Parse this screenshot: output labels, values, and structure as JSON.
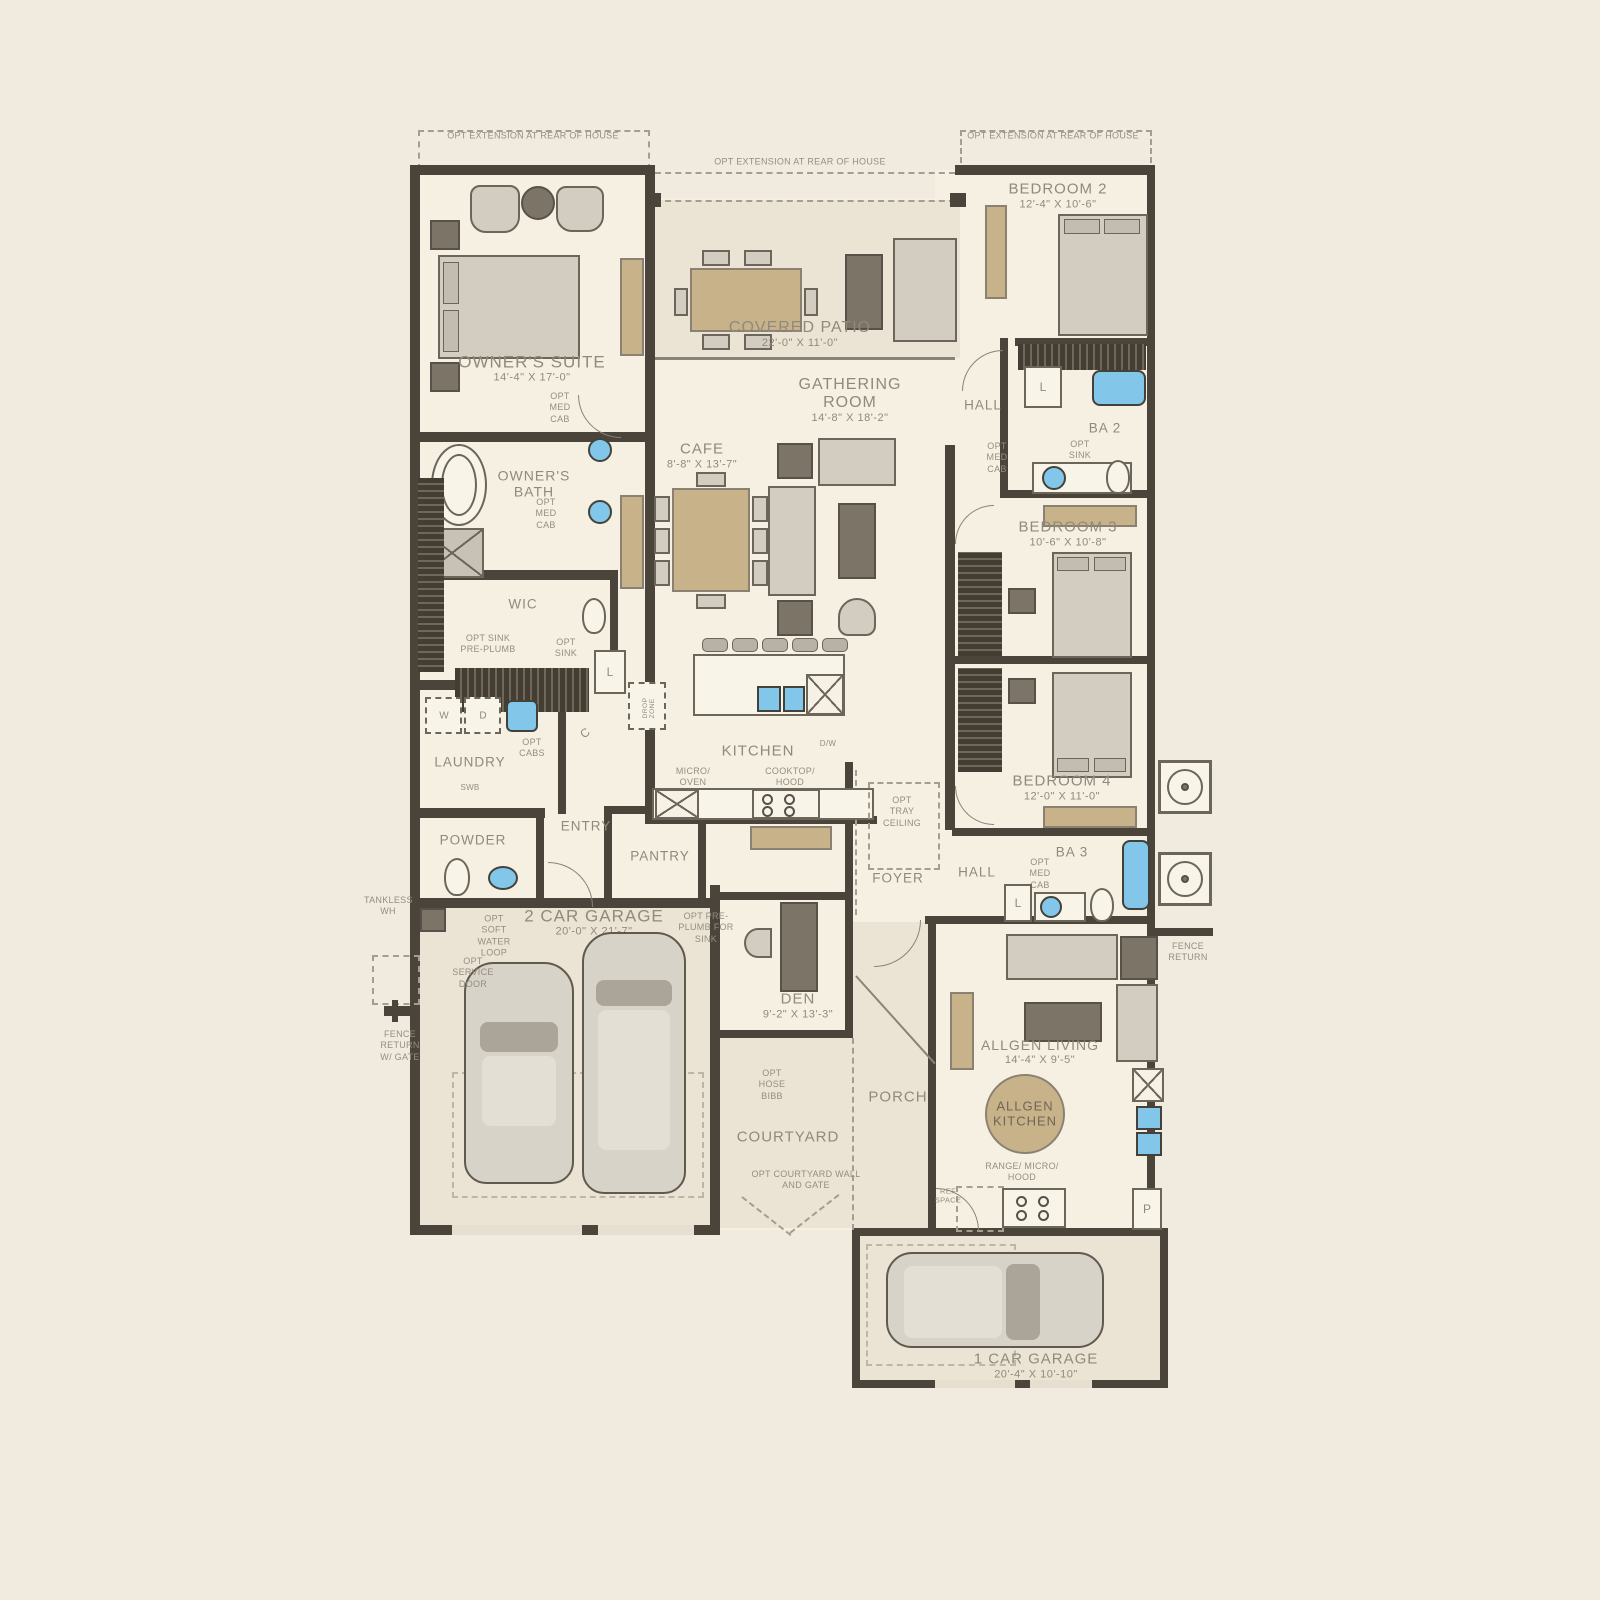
{
  "plan": {
    "rooms": {
      "owners_suite": {
        "label": "OWNER'S SUITE",
        "dims": "14'-4\" X 17'-0\""
      },
      "covered_patio": {
        "label": "COVERED PATIO",
        "dims": "22'-0\" X 11'-0\""
      },
      "bedroom2": {
        "label": "BEDROOM 2",
        "dims": "12'-4\" X 10'-6\""
      },
      "gathering": {
        "label": "GATHERING ROOM",
        "dims": "14'-8\" X 18'-2\""
      },
      "cafe": {
        "label": "CAFE",
        "dims": "8'-8\" X 13'-7\""
      },
      "owners_bath": {
        "label": "OWNER'S BATH"
      },
      "wic": {
        "label": "WIC"
      },
      "hall_rear": {
        "label": "HALL"
      },
      "ba2": {
        "label": "BA 2"
      },
      "bedroom3": {
        "label": "BEDROOM 3",
        "dims": "10'-6\" X 10'-8\""
      },
      "bedroom4": {
        "label": "BEDROOM 4",
        "dims": "12'-0\" X 11'-0\""
      },
      "kitchen": {
        "label": "KITCHEN"
      },
      "laundry": {
        "label": "LAUNDRY"
      },
      "entry": {
        "label": "ENTRY"
      },
      "powder": {
        "label": "POWDER"
      },
      "pantry": {
        "label": "PANTRY"
      },
      "foyer": {
        "label": "FOYER"
      },
      "hall_front": {
        "label": "HALL"
      },
      "ba3": {
        "label": "BA 3"
      },
      "garage2": {
        "label": "2 CAR GARAGE",
        "dims": "20'-0\" X 21'-7\""
      },
      "den": {
        "label": "DEN",
        "dims": "9'-2\" X 13'-3\""
      },
      "courtyard": {
        "label": "COURTYARD"
      },
      "porch": {
        "label": "PORCH"
      },
      "allgen_living": {
        "label": "ALLGEN LIVING",
        "dims": "14'-4\" X 9'-5\""
      },
      "allgen_kitchen": {
        "label": "ALLGEN KITCHEN"
      },
      "garage1": {
        "label": "1 CAR GARAGE",
        "dims": "20'-4\" X 10'-10\""
      }
    },
    "annotations": {
      "opt_extension": "OPT EXTENSION AT REAR OF HOUSE",
      "opt_med_cab": "OPT MED CAB",
      "opt_sink": "OPT SINK",
      "opt_sink_preplumb": "OPT SINK PRE-PLUMB",
      "opt_cabs": "OPT CABS",
      "micro_oven": "MICRO/ OVEN",
      "cooktop_hood": "COOKTOP/ HOOD",
      "dw": "D/W",
      "swb": "SWB",
      "drop_zone": "DROP ZONE",
      "tankless_wh": "TANKLESS WH",
      "opt_soft_water": "OPT SOFT WATER LOOP",
      "opt_service_door": "OPT SERVICE DOOR",
      "fence_return_gate": "FENCE RETURN W/ GATE",
      "opt_preplumb_sink": "OPT PRE-PLUMB FOR SINK",
      "opt_hose_bibb": "OPT HOSE BIBB",
      "opt_courtyard_wall": "OPT COURTYARD WALL AND GATE",
      "opt_tray_ceiling": "OPT TRAY CEILING",
      "fence_return": "FENCE RETURN",
      "range_micro_hood": "RANGE/ MICRO/ HOOD",
      "ref_space": "REF SPACE",
      "closet_l": "L",
      "closet_c": "C",
      "closet_p": "P",
      "washer": "W",
      "dryer": "D"
    },
    "colors": {
      "background": "#f0ebde",
      "wall": "#4a443a",
      "floor": "#f5f0e2",
      "label": "#8f8a7c",
      "furniture_tan": "#c8b28a",
      "furniture_gray": "#d2cdc0",
      "furniture_dark": "#7b7467",
      "fixture_blue": "#82c7e9"
    }
  }
}
